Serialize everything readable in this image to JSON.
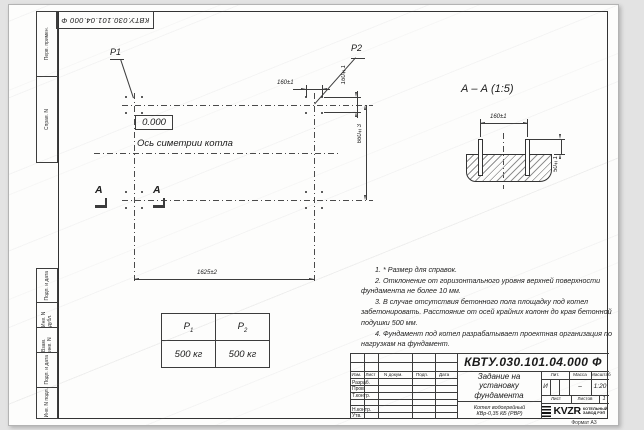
{
  "frame": {
    "stamp": "КВТУ.030.101.04.000 Ф",
    "format_label": "Формат А3",
    "side_labels": [
      "Перв. примен.",
      "Справ. N",
      "Подп. и дата",
      "Инв. N дубл.",
      "Взам. инв. N",
      "Подп. и дата",
      "Инв. N подл."
    ]
  },
  "plan": {
    "p1_label": "P1",
    "p2_label": "P2",
    "level_mark": "0.000",
    "axis_label": "Ось симетрии котла",
    "section_letter": "А",
    "dim_bolt_h": "160±1",
    "dim_bolt_v": "160±1",
    "dim_depth": "660±3",
    "dim_width": "1625±2"
  },
  "section": {
    "title": "А – А (1:5)",
    "dim_spacing": "160±1",
    "dim_height": "50±1"
  },
  "load_table": {
    "col1": {
      "label": "P",
      "sub": "1",
      "value": "500 кг"
    },
    "col2": {
      "label": "P",
      "sub": "2",
      "value": "500 кг"
    }
  },
  "notes": [
    "1. * Размер для справок.",
    "2. Отклонение от горизонтального уровня верхней поверхности фундамента не более 10 мм.",
    "3. В случае отсутствия бетонного пола площадку под котел забетонировать. Расстояние от осей крайних колонн до края бетонной подушки 500 мм.",
    "4. Фундамент под котел разрабатывает проектная организация по нагрузкам на фундамент."
  ],
  "title_block": {
    "designation": "КВТУ.030.101.04.000 Ф",
    "doc_title": "Задание на установку фундамента",
    "product_line1": "Котел водогрейный",
    "product_line2": "КВр-0,35 КБ (РВР)",
    "col_headers": [
      "Изм.",
      "Лист",
      "N докум.",
      "Подп.",
      "Дата"
    ],
    "rows": [
      "Разраб.",
      "Пров.",
      "Т.контр.",
      "",
      "Н.контр.",
      "Утв."
    ],
    "lit_label": "Лит.",
    "lit_value": "И",
    "mass_label": "Масса",
    "mass_value": "–",
    "scale_label": "Масштаб",
    "scale_value": "1:20",
    "sheet_label": "Лист",
    "sheets_label": "Листов",
    "sheets_value": "1",
    "logo_text": "KVZR",
    "org_line1": "КОТЕЛЬНЫЙ",
    "org_line2": "ЗАВОД РЭП"
  }
}
